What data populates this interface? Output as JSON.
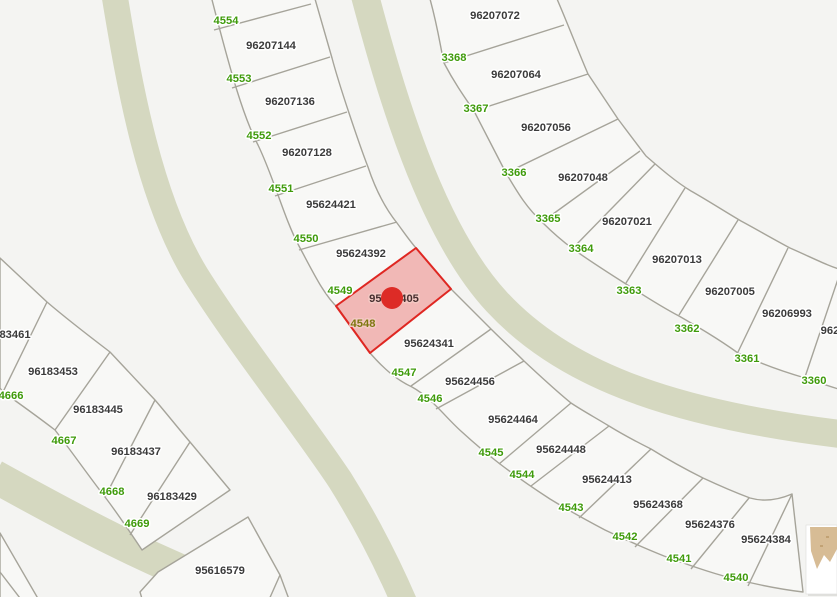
{
  "map": {
    "colors": {
      "background": "#f4f4f2",
      "parcel_fill": "#f8f8f6",
      "parcel_line": "#a6a49a",
      "street_fill": "#d5d8c0",
      "lot_label": "#3b3b3b",
      "addr_label": "#3f9b0b",
      "lot_label_highlight": "#472f2f",
      "addr_label_highlight": "#7e7810",
      "halo": "#ffffff",
      "halo_highlight": "#f3c8c3",
      "highlight_fill": "rgba(224,36,32,0.30)",
      "highlight_stroke": "#df2722",
      "marker": "#dd2b26",
      "thumb_card": "#ffffff",
      "thumb_shadow": "#e0e0dd",
      "thumb_terrain": "#d7bc95",
      "thumb_terrain_dark": "#c2a274"
    },
    "streets": [
      {
        "name": "street-band-west",
        "d": "M114,-8 C130,90 150,200 196,275 C240,345 300,420 340,480 C365,520 385,558 404,602",
        "width": 26
      },
      {
        "name": "street-band-main",
        "d": "M364,-8 C390,90 430,230 497,302 C560,370 660,412 840,434",
        "width": 28
      },
      {
        "name": "street-band-south",
        "d": "M-6,476 C70,518 150,562 258,602",
        "width": 33
      }
    ],
    "strips": [
      {
        "name": "parcel-block-curve-west",
        "outline": "M210,-8 C232,78 244,118 258,145 C274,178 284,218 299,246 C314,274 324,295 338,308 L370,353 C385,370 397,380 412,387 C432,398 446,418 462,432 C474,443 487,454 500,464 C517,477 533,488 550,499 C568,510 586,520 605,530 C624,539 644,548 664,556 C686,564 708,572 731,578 C754,584 778,589 803,592 L792,494 C778,500 764,502 750,498 C734,492 718,485 703,478 C685,469 667,459 651,449 C637,442 622,434 609,426 C596,418 583,411 571,403 C555,390 539,375 524,361 C513,350 502,340 491,329 L451,289 L416,248 C409,240 403,231 397,223 C385,208 376,191 368,167 C361,149 355,131 349,113 C343,95 337,77 332,58 C327,41 321,20 313,-8 Z",
        "lines": [
          "M214,30 L311,4",
          "M232,88 L330,57",
          "M253,142 L347,112",
          "M275,196 L366,166",
          "M299,250 L397,222",
          "M411,386 L491,329",
          "M436,409 L524,361",
          "M499,464 L571,403",
          "M531,486 L609,426",
          "M579,518 L651,449",
          "M635,547 L703,478",
          "M691,569 L749,498",
          "M748,586 L792,494"
        ]
      },
      {
        "name": "parcel-block-curve-east",
        "outline": "M428,-8 C437,22 440,45 444,63 C454,82 463,95 474,111 C485,132 495,152 506,173 C519,195 527,208 543,223 C552,232 561,240 573,249 C590,261 607,272 626,284 C643,295 660,306 679,316 C698,327 717,338 738,353 C759,363 781,371 805,378 C817,382 828,386 845,391 L845,271 C828,266 815,259 790,248 C773,239 756,229 741,221 C724,211 707,200 691,191 C676,182 661,169 646,156 C636,143 627,131 618,119 C608,104 598,89 588,74 C578,51 568,24 554,-8 Z",
        "lines": [
          "M444,63 L564,25",
          "M474,111 L588,74",
          "M506,173 L618,119",
          "M542,222 L640,151",
          "M573,248 L655,164",
          "M626,283 L685,188",
          "M679,315 L738,220",
          "M738,352 L788,248",
          "M805,377 L838,279"
        ]
      },
      {
        "name": "parcel-block-southwest",
        "outline": "M0,258 L47,302 C68,320 89,336 110,352 C125,368 140,384 155,400 C167,414 178,428 190,442 L230,490 L142,550 C130,532 118,514 105,497 C88,475 72,452 55,430 C38,417 20,404 3,392 L0,388 Z",
        "lines": [
          "M3,392 L47,302",
          "M55,430 L110,352",
          "M105,497 L155,400",
          "M130,535 L190,442"
        ]
      },
      {
        "name": "parcel-block-south",
        "outline": "M248,517 L280,575 L268,602 L143,602 L140,592 L158,572 Z",
        "lines": [
          "M280,575 L290,602"
        ]
      },
      {
        "name": "parcel-sliver-bottom-left",
        "outline": "M0,533 L40,602 L0,602 Z",
        "lines": [
          "M0,572 L23,602"
        ]
      }
    ],
    "highlight": {
      "parcel_id": "95624405",
      "polygon": "416,248 451,289 370,353 336,306"
    },
    "marker": {
      "cx": 392,
      "cy": 298,
      "r": 11
    },
    "thumbnail": {
      "shadow": {
        "x": 808,
        "y": 528,
        "w": 30,
        "h": 68
      },
      "card": {
        "x": 806,
        "y": 525,
        "w": 31,
        "h": 69
      },
      "terrain": "M810,527 L837,527 L837,549 L830,562 L824,555 L817,569 L811,551 Z",
      "marks": [
        [
          826,
          536
        ],
        [
          820,
          545
        ]
      ]
    },
    "labels": [
      {
        "text": "96207144",
        "x": 271,
        "y": 45,
        "kind": "lot"
      },
      {
        "text": "96207136",
        "x": 290,
        "y": 101,
        "kind": "lot"
      },
      {
        "text": "96207128",
        "x": 307,
        "y": 152,
        "kind": "lot"
      },
      {
        "text": "95624421",
        "x": 331,
        "y": 204,
        "kind": "lot"
      },
      {
        "text": "95624392",
        "x": 361,
        "y": 253,
        "kind": "lot"
      },
      {
        "text": "95624405",
        "x": 394,
        "y": 298,
        "kind": "lot-hl"
      },
      {
        "text": "95624341",
        "x": 429,
        "y": 343,
        "kind": "lot"
      },
      {
        "text": "95624456",
        "x": 470,
        "y": 381,
        "kind": "lot"
      },
      {
        "text": "95624464",
        "x": 513,
        "y": 419,
        "kind": "lot"
      },
      {
        "text": "95624448",
        "x": 561,
        "y": 449,
        "kind": "lot"
      },
      {
        "text": "95624413",
        "x": 607,
        "y": 479,
        "kind": "lot"
      },
      {
        "text": "95624368",
        "x": 658,
        "y": 504,
        "kind": "lot"
      },
      {
        "text": "95624376",
        "x": 710,
        "y": 524,
        "kind": "lot"
      },
      {
        "text": "95624384",
        "x": 766,
        "y": 539,
        "kind": "lot"
      },
      {
        "text": "96207072",
        "x": 495,
        "y": 15,
        "kind": "lot"
      },
      {
        "text": "96207064",
        "x": 516,
        "y": 74,
        "kind": "lot"
      },
      {
        "text": "96207056",
        "x": 546,
        "y": 127,
        "kind": "lot"
      },
      {
        "text": "96207048",
        "x": 583,
        "y": 177,
        "kind": "lot"
      },
      {
        "text": "96207021",
        "x": 627,
        "y": 221,
        "kind": "lot"
      },
      {
        "text": "96207013",
        "x": 677,
        "y": 259,
        "kind": "lot"
      },
      {
        "text": "96207005",
        "x": 730,
        "y": 291,
        "kind": "lot"
      },
      {
        "text": "96206993",
        "x": 787,
        "y": 313,
        "kind": "lot"
      },
      {
        "text": "962",
        "x": 830,
        "y": 330,
        "kind": "lot"
      },
      {
        "text": "83461",
        "x": 15,
        "y": 334,
        "kind": "lot"
      },
      {
        "text": "96183453",
        "x": 53,
        "y": 371,
        "kind": "lot"
      },
      {
        "text": "96183445",
        "x": 98,
        "y": 409,
        "kind": "lot"
      },
      {
        "text": "96183437",
        "x": 136,
        "y": 451,
        "kind": "lot"
      },
      {
        "text": "96183429",
        "x": 172,
        "y": 496,
        "kind": "lot"
      },
      {
        "text": "95616579",
        "x": 220,
        "y": 570,
        "kind": "lot"
      },
      {
        "text": "4554",
        "x": 226,
        "y": 20,
        "kind": "addr"
      },
      {
        "text": "4553",
        "x": 239,
        "y": 78,
        "kind": "addr"
      },
      {
        "text": "4552",
        "x": 259,
        "y": 135,
        "kind": "addr"
      },
      {
        "text": "4551",
        "x": 281,
        "y": 188,
        "kind": "addr"
      },
      {
        "text": "4550",
        "x": 306,
        "y": 238,
        "kind": "addr"
      },
      {
        "text": "4549",
        "x": 340,
        "y": 290,
        "kind": "addr"
      },
      {
        "text": "4548",
        "x": 363,
        "y": 323,
        "kind": "addr-hl"
      },
      {
        "text": "4547",
        "x": 404,
        "y": 372,
        "kind": "addr"
      },
      {
        "text": "4546",
        "x": 430,
        "y": 398,
        "kind": "addr"
      },
      {
        "text": "4545",
        "x": 491,
        "y": 452,
        "kind": "addr"
      },
      {
        "text": "4544",
        "x": 522,
        "y": 474,
        "kind": "addr"
      },
      {
        "text": "4543",
        "x": 571,
        "y": 507,
        "kind": "addr"
      },
      {
        "text": "4542",
        "x": 625,
        "y": 536,
        "kind": "addr"
      },
      {
        "text": "4541",
        "x": 679,
        "y": 558,
        "kind": "addr"
      },
      {
        "text": "4540",
        "x": 736,
        "y": 577,
        "kind": "addr"
      },
      {
        "text": "3368",
        "x": 454,
        "y": 57,
        "kind": "addr"
      },
      {
        "text": "3367",
        "x": 476,
        "y": 108,
        "kind": "addr"
      },
      {
        "text": "3366",
        "x": 514,
        "y": 172,
        "kind": "addr"
      },
      {
        "text": "3365",
        "x": 548,
        "y": 218,
        "kind": "addr"
      },
      {
        "text": "3364",
        "x": 581,
        "y": 248,
        "kind": "addr"
      },
      {
        "text": "3363",
        "x": 629,
        "y": 290,
        "kind": "addr"
      },
      {
        "text": "3362",
        "x": 687,
        "y": 328,
        "kind": "addr"
      },
      {
        "text": "3361",
        "x": 747,
        "y": 358,
        "kind": "addr"
      },
      {
        "text": "3360",
        "x": 814,
        "y": 380,
        "kind": "addr"
      },
      {
        "text": "4666",
        "x": 11,
        "y": 395,
        "kind": "addr"
      },
      {
        "text": "4667",
        "x": 64,
        "y": 440,
        "kind": "addr"
      },
      {
        "text": "4668",
        "x": 112,
        "y": 491,
        "kind": "addr"
      },
      {
        "text": "4669",
        "x": 137,
        "y": 523,
        "kind": "addr"
      }
    ]
  }
}
